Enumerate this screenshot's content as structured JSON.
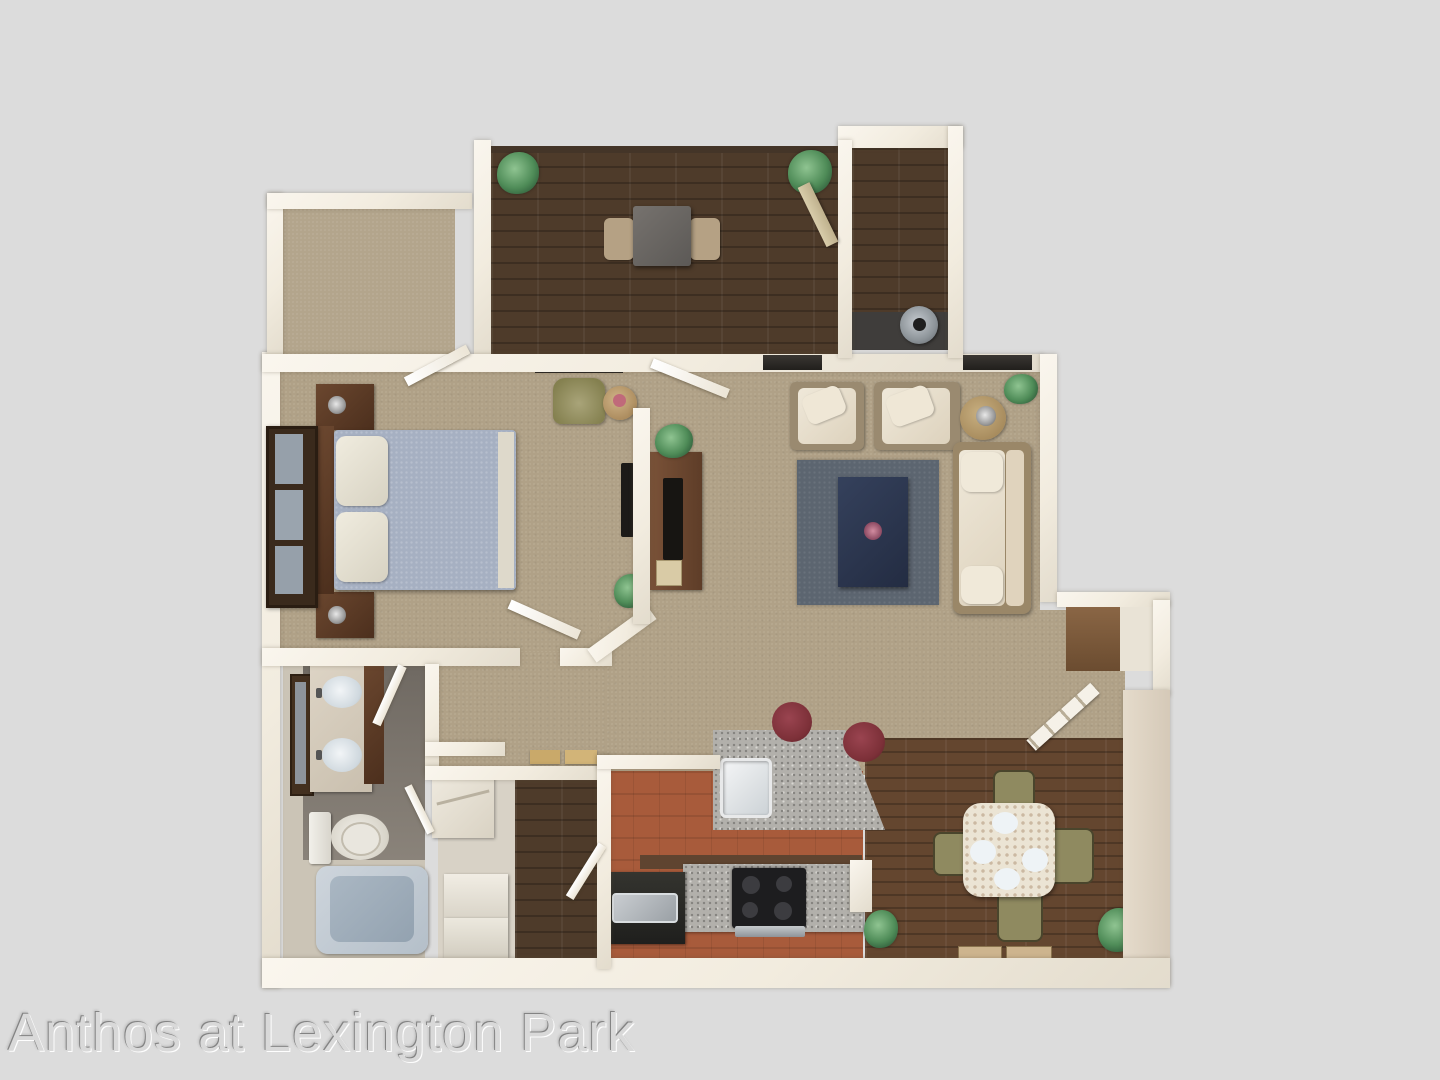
{
  "watermark": {
    "text": "Anthos at Lexington Park"
  },
  "palette": {
    "bg": "#dcdcdc",
    "wall": "#f2ecdf",
    "carpet": "#b0a187",
    "closetCarpet": "#b3a58c",
    "denWood": "#4e3b2a",
    "patioWood": "#503d2b",
    "diningWood": "#64462f",
    "kitchenTile": "#a85b3b",
    "laundryFloor": "#d8d2c6",
    "bathFloorDark": "#756f66",
    "bathFloorLight": "#cbc4b6",
    "rug": "#5c6570",
    "coffeeTable": "#2d3850",
    "sofaCream": "#e8dfcd",
    "furnWood": "#5b3b29",
    "bedComforter": "#a6b0c2",
    "stoolMaroon": "#7c3038",
    "chairOlive": "#8f8a60",
    "graniteGray": "#b2b0ab",
    "windowDark": "#2e2b27"
  }
}
